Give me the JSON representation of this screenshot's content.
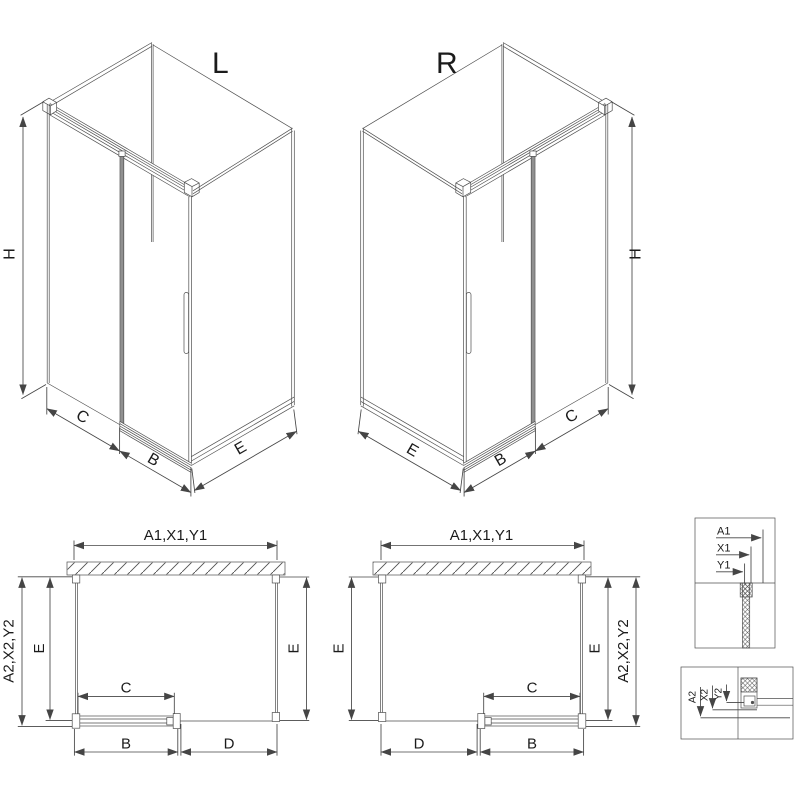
{
  "views": {
    "isoLeft": {
      "title": "L",
      "h": "H",
      "c": "C",
      "b": "B",
      "e": "E"
    },
    "isoRight": {
      "title": "R",
      "h": "H",
      "c": "C",
      "b": "B",
      "e": "E"
    },
    "planLeft": {
      "top": "A1,X1,Y1",
      "outer": "A2,X2,Y2",
      "eLeft": "E",
      "eRight": "E",
      "c": "C",
      "b": "B",
      "d": "D"
    },
    "planRight": {
      "top": "A1,X1,Y1",
      "outer": "A2,X2,Y2",
      "eLeft": "E",
      "eRight": "E",
      "c": "C",
      "b": "B",
      "d": "D"
    },
    "detailTop": {
      "a1": "A1",
      "x1": "X1",
      "y1": "Y1"
    },
    "detailBottom": {
      "a2": "A2",
      "x2": "X2",
      "y2": "Y2"
    }
  },
  "colors": {
    "line": "#4f4f4f",
    "dim": "#454545",
    "text": "#1b1b1b",
    "glassEdge": "#909090",
    "arrow": "#454545",
    "bg": "#ffffff"
  }
}
